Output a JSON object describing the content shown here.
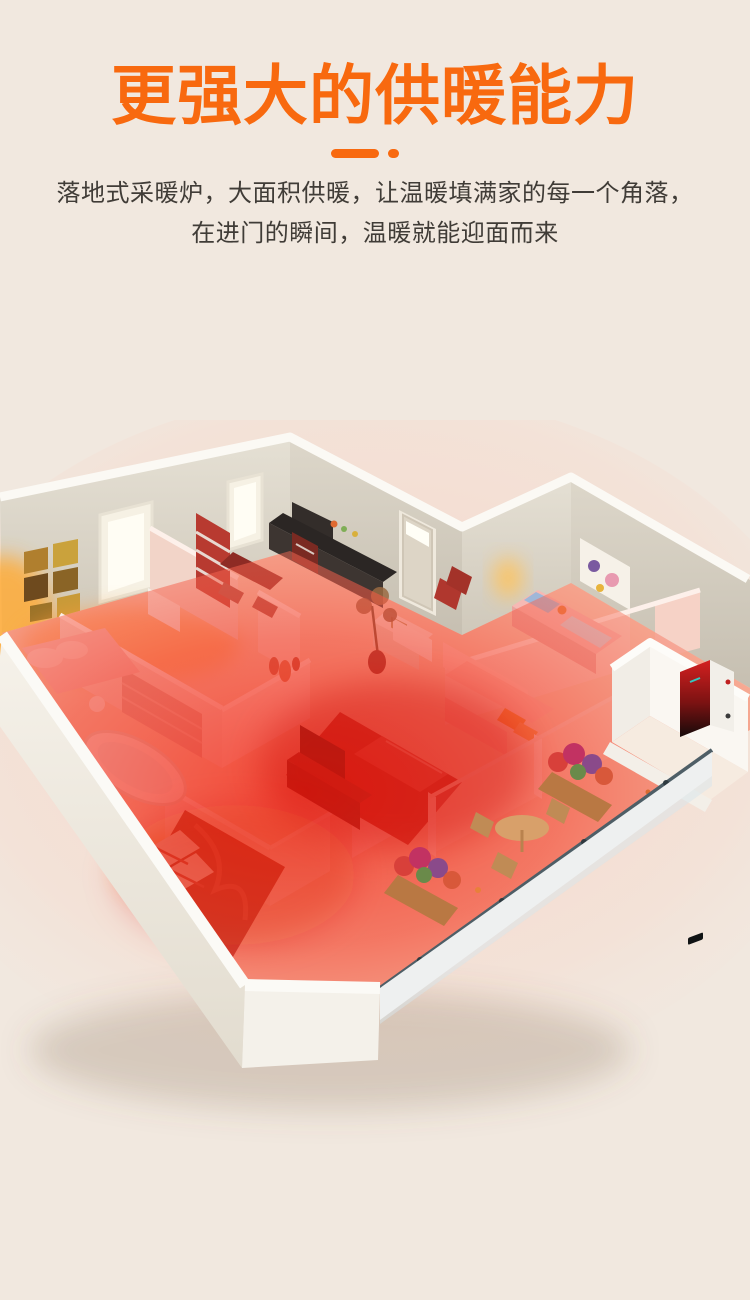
{
  "page": {
    "background_color": "#f1e8df",
    "accent_color": "#f8690f"
  },
  "header": {
    "title": "更强大的供暖能力",
    "title_color": "#f8690f",
    "subtitle_line1": "落地式采暖炉，大面积供暖，让温暖填满家的每一个角落，",
    "subtitle_line2": "在进门的瞬间，温暖就能迎面而来",
    "subtitle_color": "#403c37"
  },
  "hero": {
    "heat_overlay_color": "#f2402a",
    "wall_color": "#d8d2c5",
    "floor_color": "#f4cdb6",
    "heater_unit": {
      "front_color": "#d42020",
      "dark_color": "#160a0a",
      "side_color": "#f2efe9"
    }
  }
}
